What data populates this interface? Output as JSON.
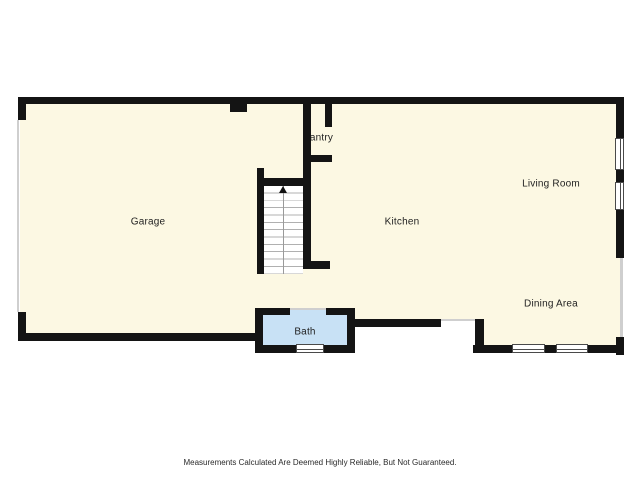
{
  "floorplan": {
    "rooms": {
      "garage": "Garage",
      "pantry": "Pantry",
      "kitchen": "Kitchen",
      "living_room": "Living Room",
      "dining_area": "Dining Area",
      "bath": "Bath"
    },
    "colors": {
      "floor_fill": "#fcf8e3",
      "bath_fill": "#c8e1f5",
      "wall": "#141414",
      "window_frame": "#4a4a4a",
      "opening_line": "#cfcfcf",
      "background": "#ffffff"
    },
    "icons": {
      "stairs_direction": "up-arrow"
    },
    "disclaimer": "Measurements Calculated Are Deemed Highly Reliable, But Not Guaranteed."
  }
}
